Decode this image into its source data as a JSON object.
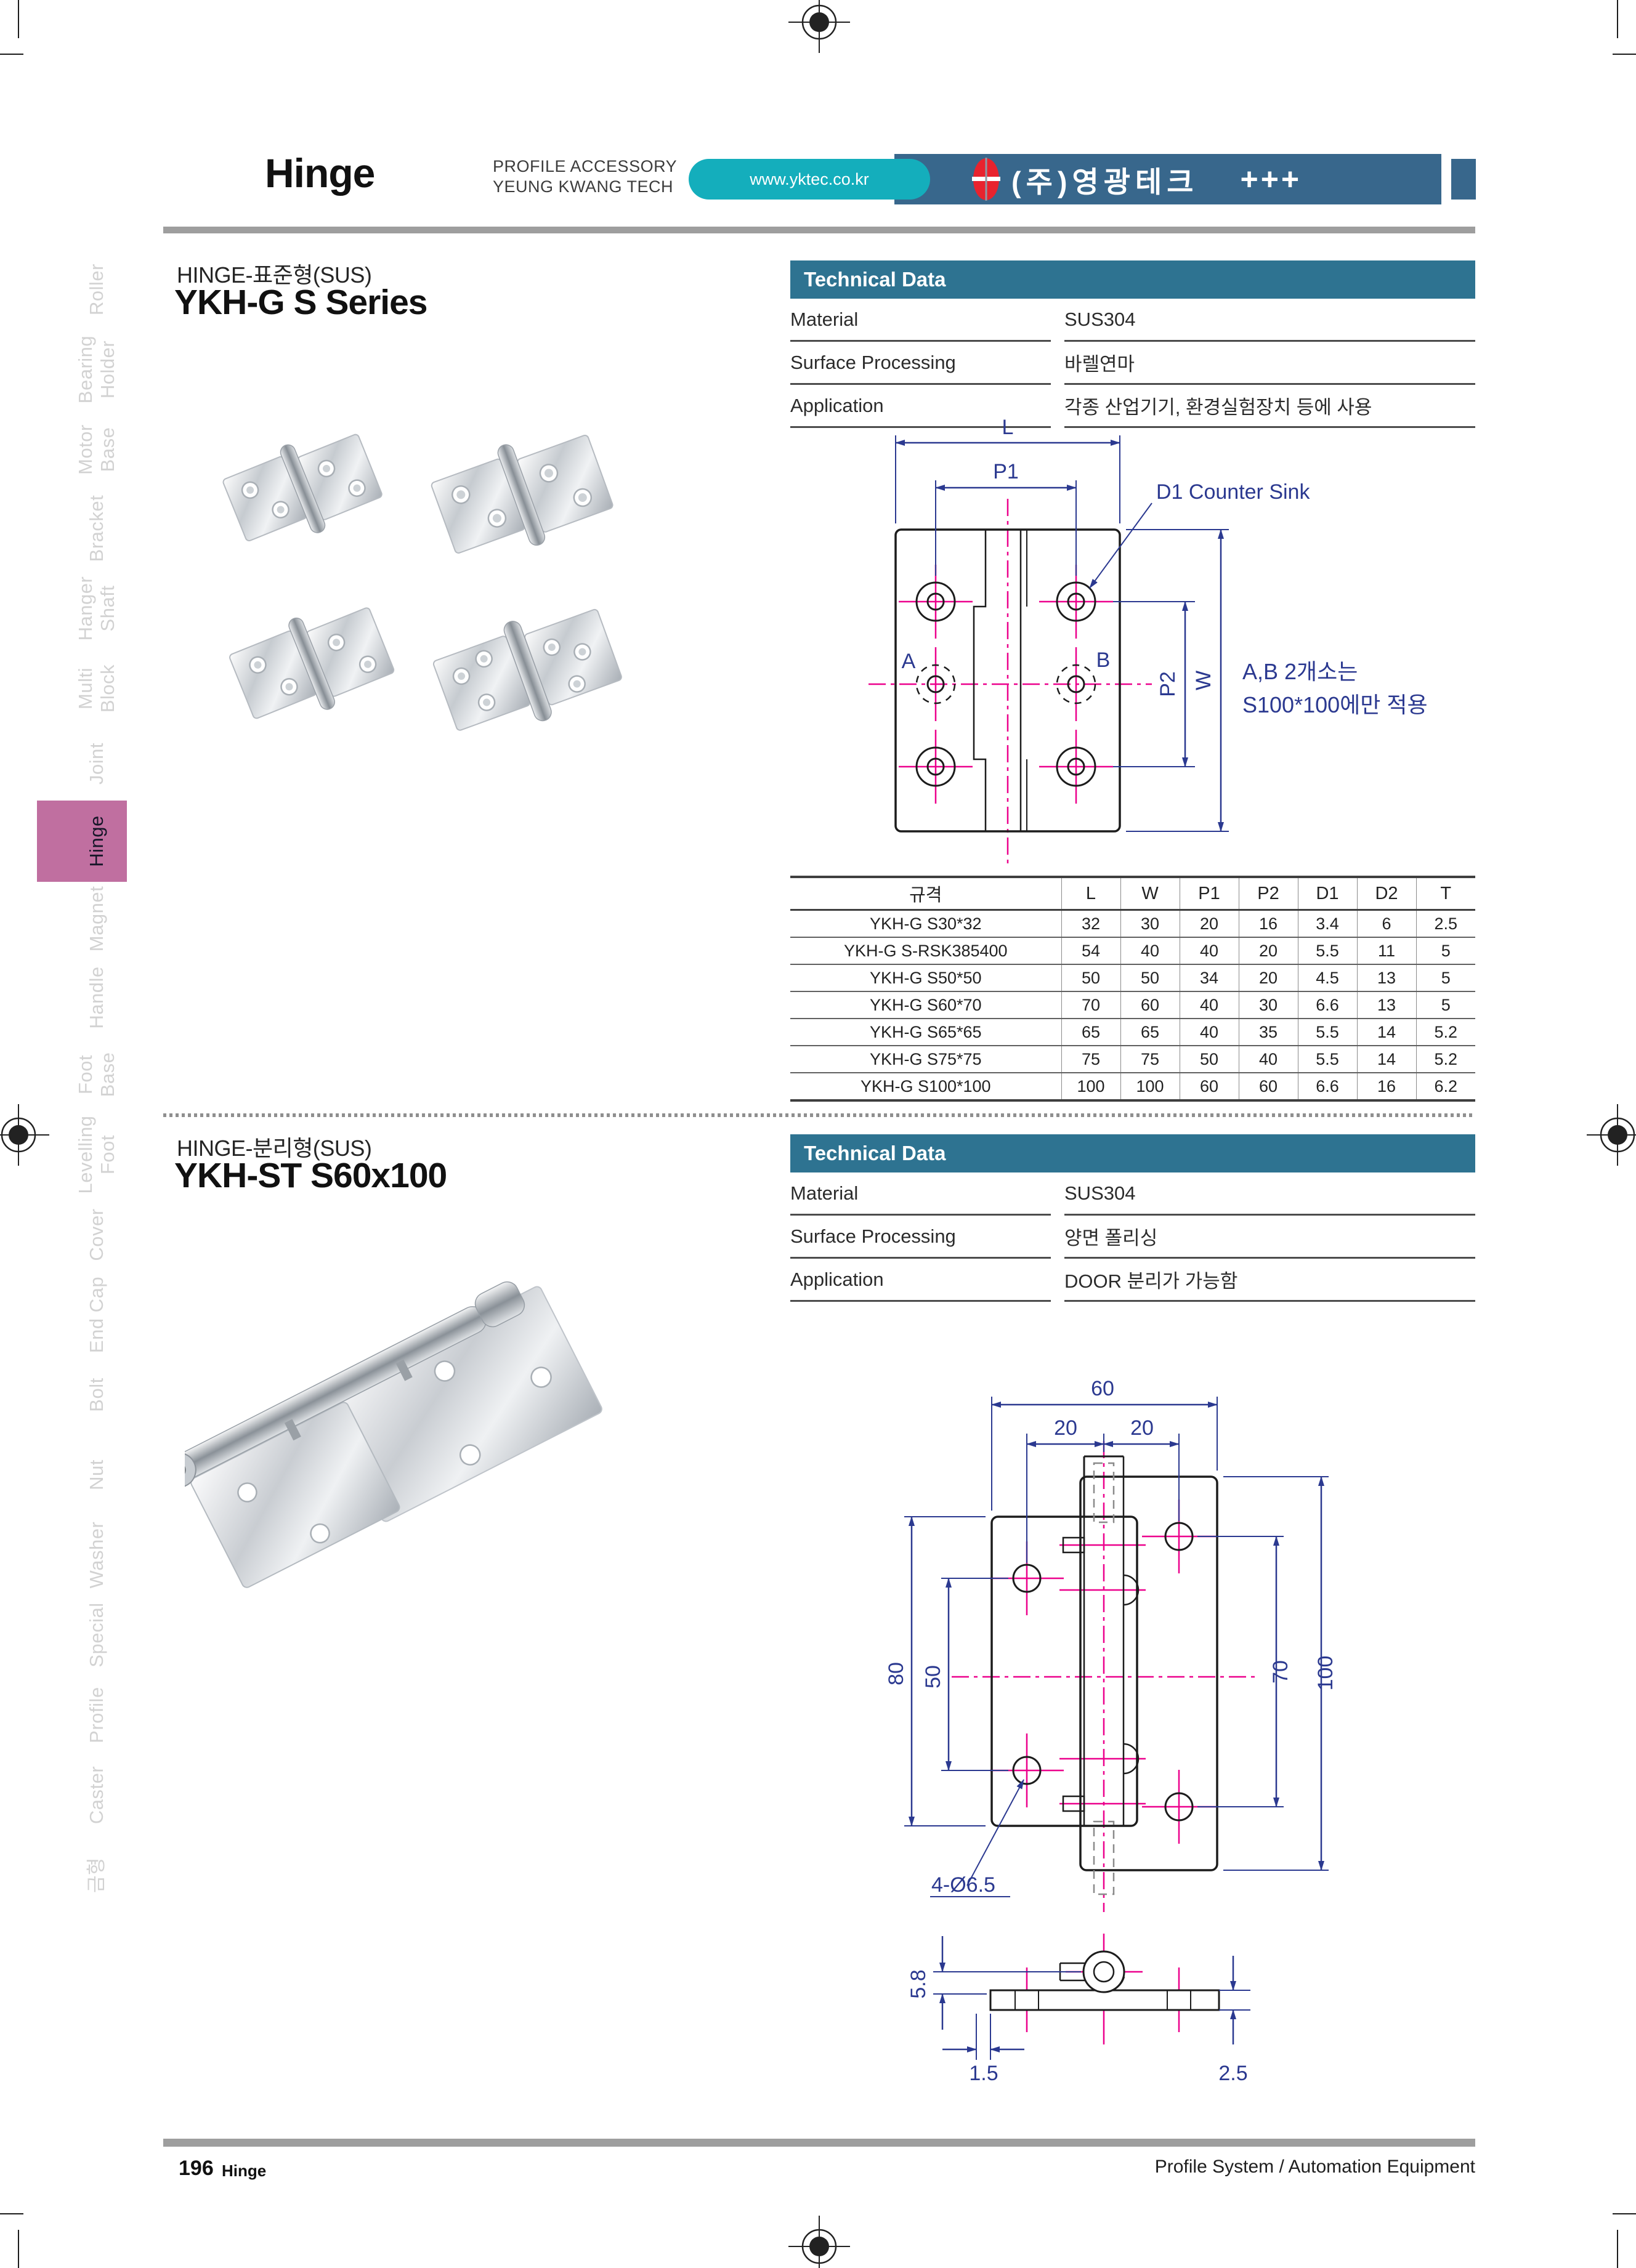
{
  "header": {
    "title": "Hinge",
    "subtitle_line1": "PROFILE ACCESSORY",
    "subtitle_line2": "YEUNG KWANG TECH",
    "website": "www.yktec.co.kr",
    "company": "(주)영광테크",
    "plus_marks": "+++"
  },
  "sidebar": {
    "items": [
      {
        "line1": "Roller"
      },
      {
        "line1": "Bearing",
        "line2": "Holder"
      },
      {
        "line1": "Motor",
        "line2": "Base"
      },
      {
        "line1": "Bracket"
      },
      {
        "line1": "Hanger",
        "line2": "Shaft"
      },
      {
        "line1": "Multi",
        "line2": "Block"
      },
      {
        "line1": "Joint"
      },
      {
        "line1": "Hinge",
        "active": true
      },
      {
        "line1": "Magnet"
      },
      {
        "line1": "Handle"
      },
      {
        "line1": "Foot",
        "line2": "Base"
      },
      {
        "line1": "Levelling",
        "line2": "Foot"
      },
      {
        "line1": "Cover"
      },
      {
        "line1": "End Cap"
      },
      {
        "line1": "Bolt"
      },
      {
        "line1": "Nut"
      },
      {
        "line1": "Washer"
      },
      {
        "line1": "Special"
      },
      {
        "line1": "Profile"
      },
      {
        "line1": "Caster"
      },
      {
        "line1": "금형"
      }
    ]
  },
  "section1": {
    "category": "HINGE-표준형(SUS)",
    "title": "YKH-G S Series",
    "technical_data": {
      "header": "Technical Data",
      "rows": [
        {
          "label": "Material",
          "value": "SUS304"
        },
        {
          "label": "Surface Processing",
          "value": "바렐연마"
        },
        {
          "label": "Application",
          "value": "각종 산업기기, 환경실험장치 등에 사용"
        }
      ]
    },
    "drawing": {
      "dim_l": "L",
      "dim_p1": "P1",
      "callout_d1": "D1 Counter Sink",
      "label_a": "A",
      "label_b": "B",
      "dim_p2": "P2",
      "dim_w": "W",
      "note_line1": "A,B 2개소는",
      "note_line2": "S100*100에만 적용",
      "callout_d2": "D2",
      "dim_t": "T"
    },
    "spec_table": {
      "headers": [
        "규격",
        "L",
        "W",
        "P1",
        "P2",
        "D1",
        "D2",
        "T"
      ],
      "rows": [
        [
          "YKH-G S30*32",
          "32",
          "30",
          "20",
          "16",
          "3.4",
          "6",
          "2.5"
        ],
        [
          "YKH-G S-RSK385400",
          "54",
          "40",
          "40",
          "20",
          "5.5",
          "11",
          "5"
        ],
        [
          "YKH-G S50*50",
          "50",
          "50",
          "34",
          "20",
          "4.5",
          "13",
          "5"
        ],
        [
          "YKH-G S60*70",
          "70",
          "60",
          "40",
          "30",
          "6.6",
          "13",
          "5"
        ],
        [
          "YKH-G S65*65",
          "65",
          "65",
          "40",
          "35",
          "5.5",
          "14",
          "5.2"
        ],
        [
          "YKH-G S75*75",
          "75",
          "75",
          "50",
          "40",
          "5.5",
          "14",
          "5.2"
        ],
        [
          "YKH-G S100*100",
          "100",
          "100",
          "60",
          "60",
          "6.6",
          "16",
          "6.2"
        ]
      ]
    }
  },
  "section2": {
    "category": "HINGE-분리형(SUS)",
    "title": "YKH-ST S60x100",
    "technical_data": {
      "header": "Technical Data",
      "rows": [
        {
          "label": "Material",
          "value": "SUS304"
        },
        {
          "label": "Surface Processing",
          "value": "양면 폴리싱"
        },
        {
          "label": "Application",
          "value": "DOOR 분리가 가능함"
        }
      ]
    },
    "drawing": {
      "dim_total_width": "60",
      "dim_left_pitch": "20",
      "dim_right_pitch": "20",
      "dim_left_height": "80",
      "dim_left_hole_pitch": "50",
      "dim_right_hole_pitch": "70",
      "dim_right_height": "100",
      "callout_holes": "4-Ø6.5",
      "dim_pin_height": "5.8",
      "dim_offset": "1.5",
      "dim_thickness": "2.5"
    }
  },
  "footer": {
    "page_number": "196",
    "page_label": "Hinge",
    "right_text": "Profile System / Automation Equipment"
  },
  "colors": {
    "accent_blue": "#2e7391",
    "banner_blue": "#38678c",
    "pill_teal": "#14aebc",
    "tab_pink": "#c06fa0",
    "logo_red": "#e8232e",
    "dim_navy": "#2b3990",
    "centerline_magenta": "#ec008c"
  }
}
